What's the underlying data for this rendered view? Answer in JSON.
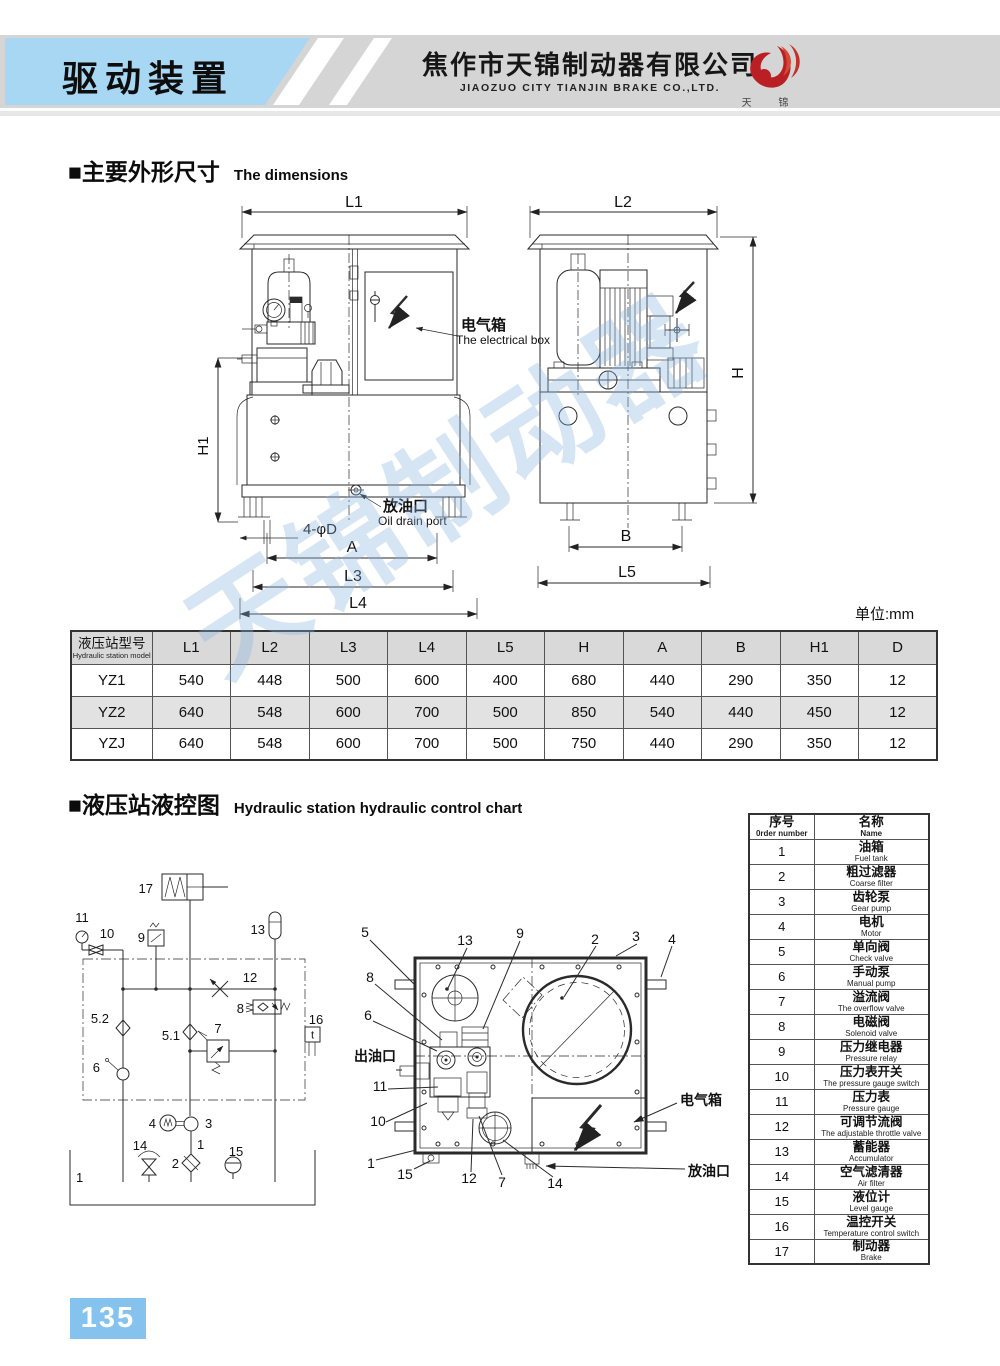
{
  "header": {
    "title_cn": "驱动装置",
    "company_cn": "焦作市天锦制动器有限公司",
    "company_en": "JIAOZUO CITY TIANJIN BRAKE CO.,LTD.",
    "logo_text": "天  锦",
    "accent_color": "#a8d7f3",
    "band_color": "#d5d5d5",
    "logo_color": "#b91f23"
  },
  "section1": {
    "title_cn": "■主要外形尺寸",
    "title_en": "The  dimensions",
    "unit_note": "单位:mm"
  },
  "drawing": {
    "labels": {
      "l1": "L1",
      "l2": "L2",
      "h": "H",
      "h1": "H1",
      "a": "A",
      "b": "B",
      "l3": "L3",
      "l4": "L4",
      "l5": "L5",
      "holes": "4-φD",
      "ebox_cn": "电气箱",
      "ebox_en": "The electrical box",
      "drain_cn": "放油口",
      "drain_en": "Oil drain port"
    }
  },
  "dim_table": {
    "header_model_cn": "液压站型号",
    "header_model_en": "Hydraulic station model",
    "columns": [
      "L1",
      "L2",
      "L3",
      "L4",
      "L5",
      "H",
      "A",
      "B",
      "H1",
      "D"
    ],
    "rows": [
      [
        "YZ1",
        "540",
        "448",
        "500",
        "600",
        "400",
        "680",
        "440",
        "290",
        "350",
        "12"
      ],
      [
        "YZ2",
        "640",
        "548",
        "600",
        "700",
        "500",
        "850",
        "540",
        "440",
        "450",
        "12"
      ],
      [
        "YZJ",
        "640",
        "548",
        "600",
        "700",
        "500",
        "750",
        "440",
        "290",
        "350",
        "12"
      ]
    ]
  },
  "section2": {
    "title_cn": "■液压站液控图",
    "title_en": "Hydraulic station hydraulic control chart"
  },
  "schematic": {
    "callouts": {
      "c17": "17",
      "c11": "11",
      "c10": "10",
      "c9": "9",
      "c13": "13",
      "c12": "12",
      "c8": "8",
      "c16": "16",
      "t": "t",
      "c52": "5.2",
      "c51": "5.1",
      "c7": "7",
      "c6": "6",
      "c4": "4",
      "c3": "3",
      "c1p": "1",
      "c2": "2",
      "c14": "14",
      "c15": "15",
      "c1": "1"
    }
  },
  "topview": {
    "callouts": {
      "c5": "5",
      "c13": "13",
      "c9": "9",
      "c2": "2",
      "c3": "3",
      "c4": "4",
      "c8": "8",
      "c6": "6",
      "outlet": "出油口",
      "c11": "11",
      "c10": "10",
      "c1": "1",
      "c15": "15",
      "c12": "12",
      "c7": "7",
      "c14": "14",
      "ebox": "电气箱",
      "drain": "放油口"
    }
  },
  "parts_table": {
    "header_no_cn": "序号",
    "header_no_en": "0rder number",
    "header_name_cn": "名称",
    "header_name_en": "Name",
    "rows": [
      {
        "no": "1",
        "cn": "油箱",
        "en": "Fuel tank"
      },
      {
        "no": "2",
        "cn": "粗过滤器",
        "en": "Coarse filter"
      },
      {
        "no": "3",
        "cn": "齿轮泵",
        "en": "Gear pump"
      },
      {
        "no": "4",
        "cn": "电机",
        "en": "Motor"
      },
      {
        "no": "5",
        "cn": "单向阀",
        "en": "Check valve"
      },
      {
        "no": "6",
        "cn": "手动泵",
        "en": "Manual pump"
      },
      {
        "no": "7",
        "cn": "溢流阀",
        "en": "The overflow valve"
      },
      {
        "no": "8",
        "cn": "电磁阀",
        "en": "Solenoid valve"
      },
      {
        "no": "9",
        "cn": "压力继电器",
        "en": "Pressure relay"
      },
      {
        "no": "10",
        "cn": "压力表开关",
        "en": "The pressure gauge switch"
      },
      {
        "no": "11",
        "cn": "压力表",
        "en": "Pressure gauge"
      },
      {
        "no": "12",
        "cn": "可调节流阀",
        "en": "The adjustable throttle valve"
      },
      {
        "no": "13",
        "cn": "蓄能器",
        "en": "Accumulator"
      },
      {
        "no": "14",
        "cn": "空气滤清器",
        "en": "Air filter"
      },
      {
        "no": "15",
        "cn": "液位计",
        "en": "Level gauge"
      },
      {
        "no": "16",
        "cn": "温控开关",
        "en": "Temperature control switch"
      },
      {
        "no": "17",
        "cn": "制动器",
        "en": "Brake"
      }
    ]
  },
  "watermark": {
    "text": "天锦制动器"
  },
  "footer": {
    "page_number": "135"
  }
}
